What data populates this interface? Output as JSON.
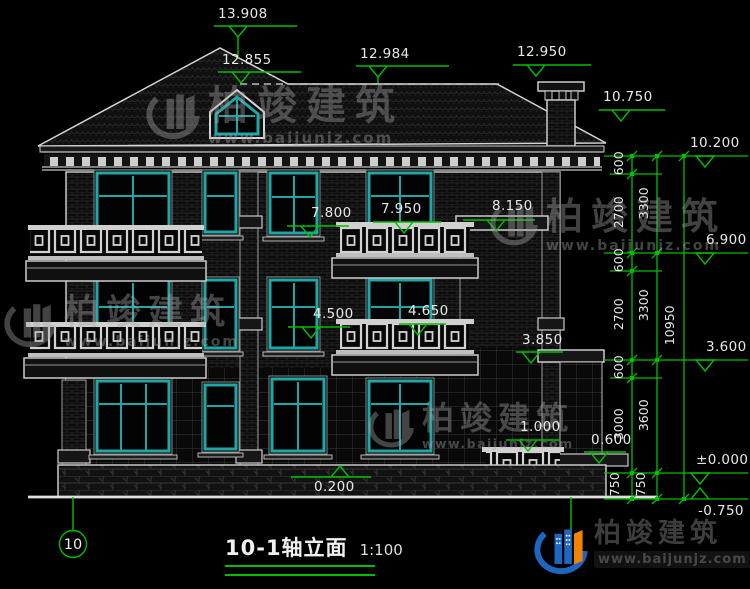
{
  "title": {
    "name": "10-1轴立面",
    "scale": "1:100"
  },
  "axis": {
    "label": "10"
  },
  "brand": {
    "name": "柏竣建筑",
    "url": "www.baijunjz.com"
  },
  "colors": {
    "background": "#000000",
    "linework": "#d5d5d5",
    "window_frame_teal": "#1fa7a7",
    "dimension_green": "#00bf00",
    "label_text": "#e8e8e8",
    "watermark_gray": "#a6a6a6",
    "logo_blue": "#1d66c2",
    "logo_orange": "#f08300"
  },
  "markers": {
    "m13908": "13.908",
    "m12984": "12.984",
    "m12950": "12.950",
    "m12855": "12.855",
    "m10750": "10.750",
    "m10200": "10.200",
    "m6900": "6.900",
    "m3600": "3.600",
    "m0000": "±0.000",
    "mneg750": "-0.750",
    "m7800": "7.800",
    "m7950": "7.950",
    "m8150": "8.150",
    "m4500": "4.500",
    "m4650": "4.650",
    "m3850": "3.850",
    "m1000": "1.000",
    "m0600": "0.600",
    "m0200": "0.200"
  },
  "dims": {
    "col1": [
      "600",
      "2700",
      "600",
      "2700",
      "600",
      "3000",
      "750"
    ],
    "col2": [
      "3300",
      "3300",
      "3600",
      "750"
    ],
    "col3": [
      "10950"
    ]
  }
}
